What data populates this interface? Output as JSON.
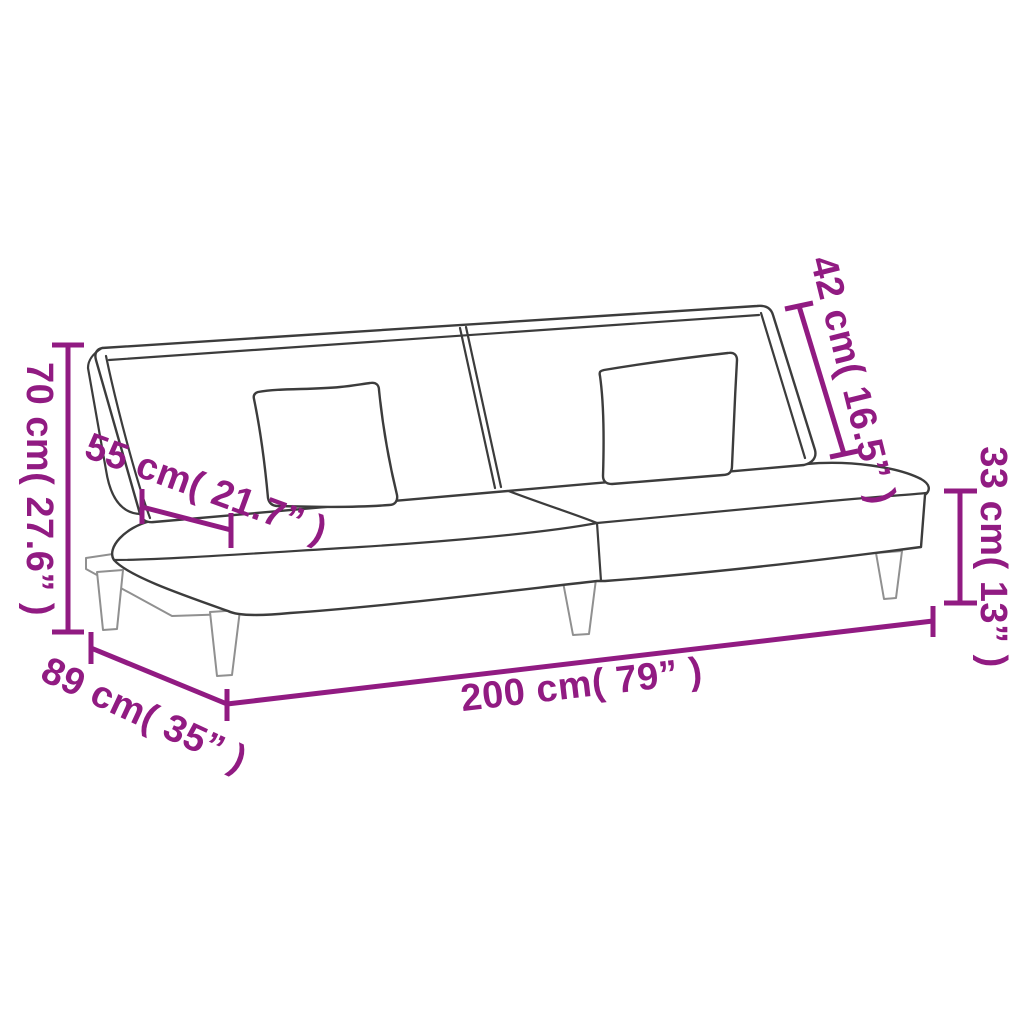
{
  "diagram": {
    "type": "product-dimension-diagram",
    "product": "sofa-bed-line-drawing",
    "colors": {
      "accent": "#911b82",
      "outline": "#3c3c3c",
      "outline_light": "#909090",
      "background": "#ffffff"
    },
    "dimensions": {
      "overall_height": {
        "label": "70 cm( 27.6” )",
        "cm": "70",
        "inches": "27.6”"
      },
      "seat_depth": {
        "label": "55 cm( 21.7” )",
        "cm": "55",
        "inches": "21.7”"
      },
      "backrest_height": {
        "label": "42 cm( 16.5” )",
        "cm": "42",
        "inches": "16.5”"
      },
      "seat_height": {
        "label": "33 cm( 13” )",
        "cm": "33",
        "inches": "13”"
      },
      "overall_width": {
        "label": "200 cm( 79” )",
        "cm": "200",
        "inches": "79”"
      },
      "overall_depth": {
        "label": "89 cm( 35” )",
        "cm": "89",
        "inches": "35”"
      }
    }
  }
}
